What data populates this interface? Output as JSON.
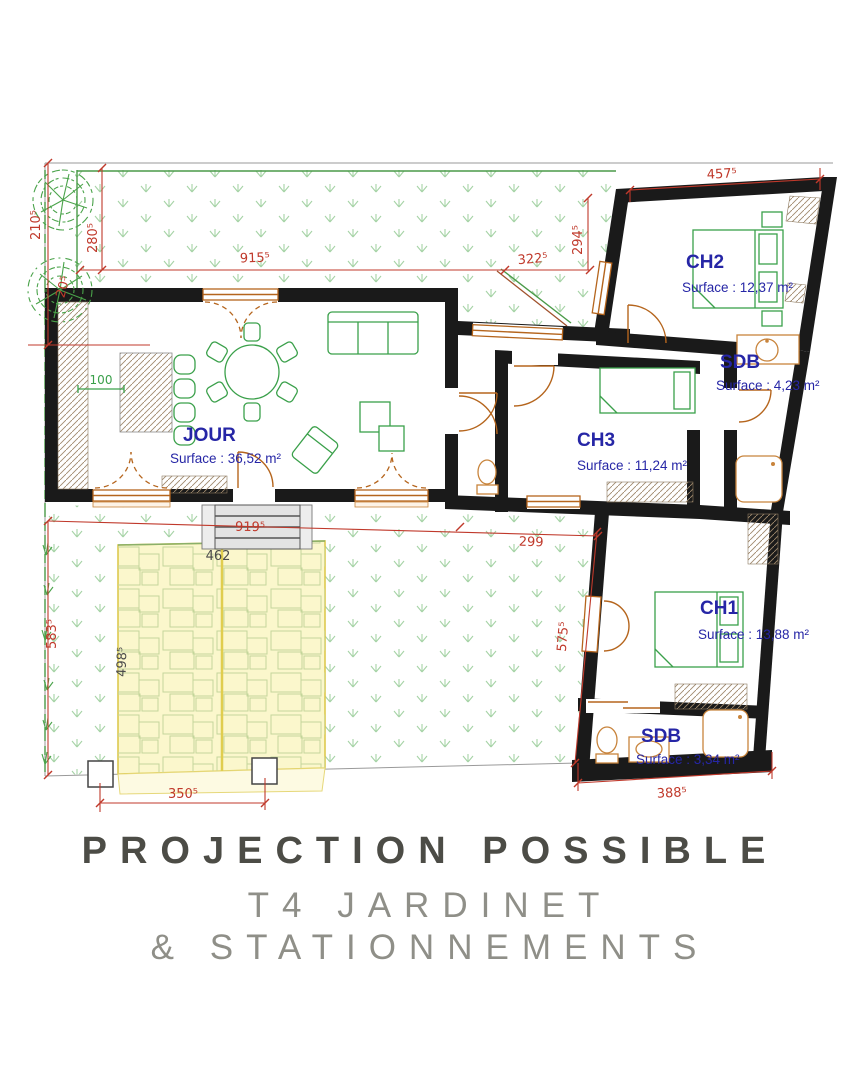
{
  "title": {
    "line1": "PROJECTION POSSIBLE",
    "line2": "T4 JARDINET",
    "line3": "& STATIONNEMENTS"
  },
  "rooms": {
    "jour": {
      "name": "JOUR",
      "surface": "Surface : 36,52 m²"
    },
    "ch2": {
      "name": "CH2",
      "surface": "Surface : 12,37 m²"
    },
    "sdb1": {
      "name": "SDB",
      "surface": "Surface : 4,23 m²"
    },
    "ch3": {
      "name": "CH3",
      "surface": "Surface : 11,24 m²"
    },
    "ch1": {
      "name": "CH1",
      "surface": "Surface : 13,88 m²"
    },
    "sdb2": {
      "name": "SDB",
      "surface": "Surface : 3,34 m²"
    }
  },
  "dimensions": {
    "left_upper": "210⁵",
    "garden_depth": "280⁵",
    "corner_offset": "20⁵",
    "garden_width": "915⁵",
    "garden_right": "322⁵",
    "ch2_setback": "294⁵",
    "ch2_width": "457⁵",
    "kitchen_clearance": "100",
    "terrace_width": "919⁵",
    "path_width": "299",
    "parking_width": "462",
    "garden_south_height": "583⁵",
    "parking_depth": "498⁵",
    "ch1_side": "575⁵",
    "parking_span": "350⁵",
    "sdb2_width": "388⁵"
  },
  "colors": {
    "wall": "#1a1a1a",
    "dimension_red": "#c0392b",
    "dimension_gray": "#4a4a4a",
    "room_label_blue": "#2626a6",
    "furniture_green": "#3aa04a",
    "grass_green": "#a6d3a6",
    "parking_yellow": "#fbf7cc",
    "joinery_tan": "#b5651d",
    "title_dark": "#4c4c46",
    "title_light": "#8f8f88"
  }
}
